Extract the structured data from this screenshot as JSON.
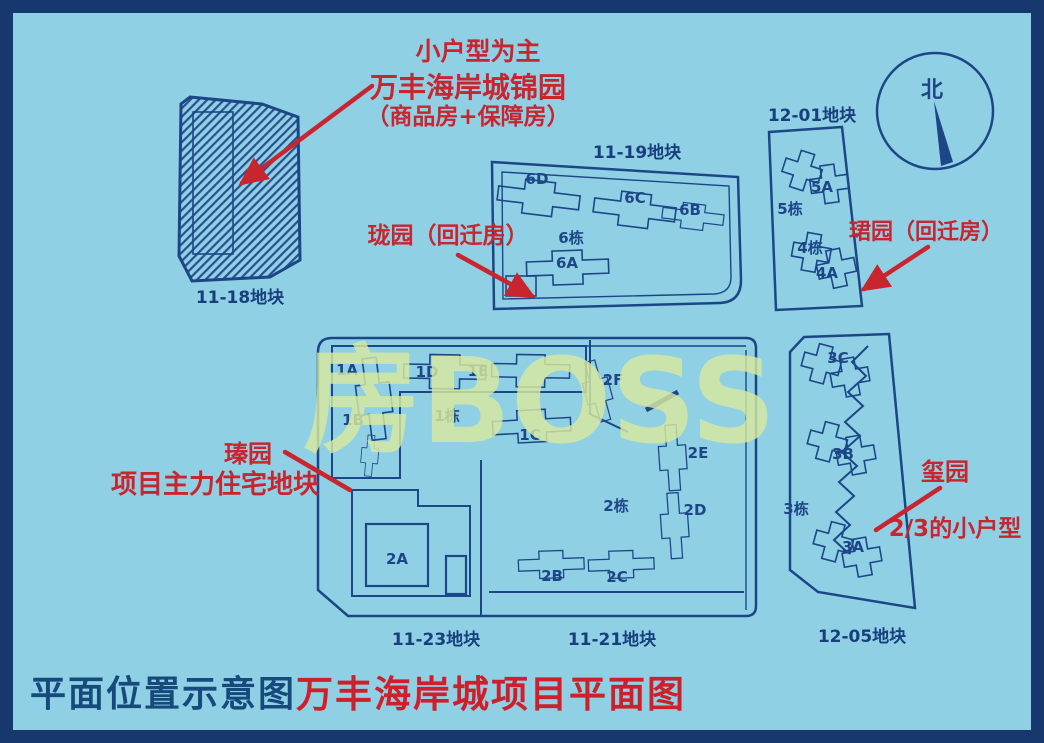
{
  "colors": {
    "background": "#8fd0e5",
    "frame": "#16386e",
    "line": "#1d4687",
    "annotation_red": "#c9252f",
    "title_red": "#cf1f2a",
    "watermark": "#d8e9a0"
  },
  "watermark": "房BOSS",
  "compass": {
    "north_label": "北"
  },
  "footer": {
    "left_title": "平面位置示意图",
    "right_title": "万丰海岸城项目平面图"
  },
  "annotations": {
    "top": {
      "line1": "小户型为主",
      "line2": "万丰海岸城锦园",
      "line3": "（商品房+保障房）"
    },
    "longyuan": "珑园（回迁房）",
    "junyuan": "珺园（回迁房）",
    "zhenyuan": {
      "line1": "瑧园",
      "line2": "项目主力住宅地块"
    },
    "xiyuan": {
      "line1": "玺园",
      "line2": "2/3的小户型"
    }
  },
  "plots": {
    "p1118": {
      "label": "11-18地块"
    },
    "p1119": {
      "label": "11-19地块",
      "b6d": "6D",
      "b6c": "6C",
      "b6b": "6B",
      "b6dong": "6栋",
      "b6a": "6A"
    },
    "p1201": {
      "label": "12-01地块",
      "b5a": "5A",
      "b5dong": "5栋",
      "b4dong": "4栋",
      "b4a": "4A"
    },
    "p1123": {
      "label": "11-23地块",
      "b2a": "2A"
    },
    "p1121": {
      "label": "11-21地块",
      "b1a": "1A",
      "b1b": "1B",
      "b1d": "1D",
      "b1e": "1E",
      "b1dong": "1栋",
      "b1c": "1C",
      "b2f": "2F",
      "b2e": "2E",
      "b2dong": "2栋",
      "b2d": "2D",
      "b2b": "2B",
      "b2c": "2C"
    },
    "p1205": {
      "label": "12-05地块",
      "b3c": "3C",
      "b3b": "3B",
      "b3dong": "3栋",
      "b3a": "3A"
    }
  }
}
